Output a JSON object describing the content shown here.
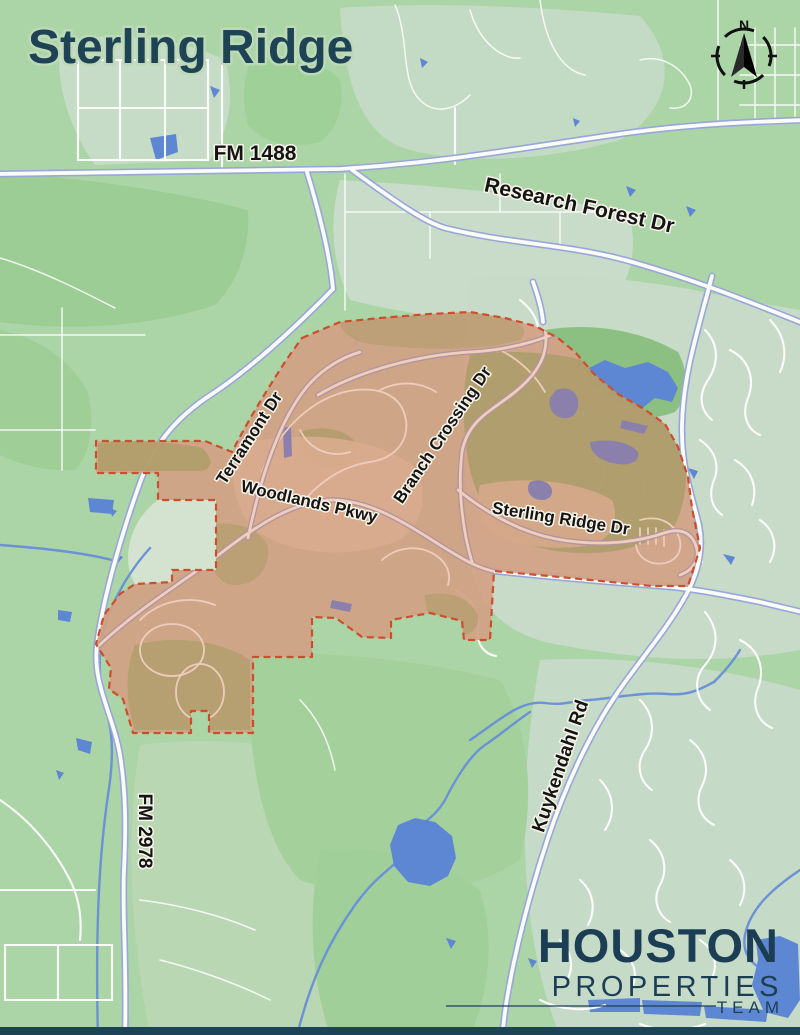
{
  "title": "Sterling Ridge",
  "compass": {
    "north": "N"
  },
  "roads": {
    "fm_1488": "FM 1488",
    "research_forest_dr": "Research Forest Dr",
    "terramont_dr": "Terramont Dr",
    "branch_crossing_dr": "Branch Crossing Dr",
    "woodlands_pkwy": "Woodlands Pkwy",
    "sterling_ridge_dr": "Sterling Ridge Dr",
    "kuykendahl_rd": "Kuykendahl Rd",
    "fm_2978": "FM 2978"
  },
  "region": {
    "name": "Sterling Ridge",
    "fill": "#d2a185",
    "border": "#cc4e2d"
  },
  "logo": {
    "brand_top": "HOUSTON",
    "brand_bottom": "PROPERTIES",
    "team": "TEAM"
  },
  "colors": {
    "title_text": "#1d4355",
    "logo_text": "#1c3e55",
    "land": "#acd5a7",
    "water": "#5d87d2",
    "highway_casing": "#98a7d9",
    "region_fill": "#d2a185",
    "region_border": "#cc4e2d",
    "footer_bar": "#1d4456"
  }
}
